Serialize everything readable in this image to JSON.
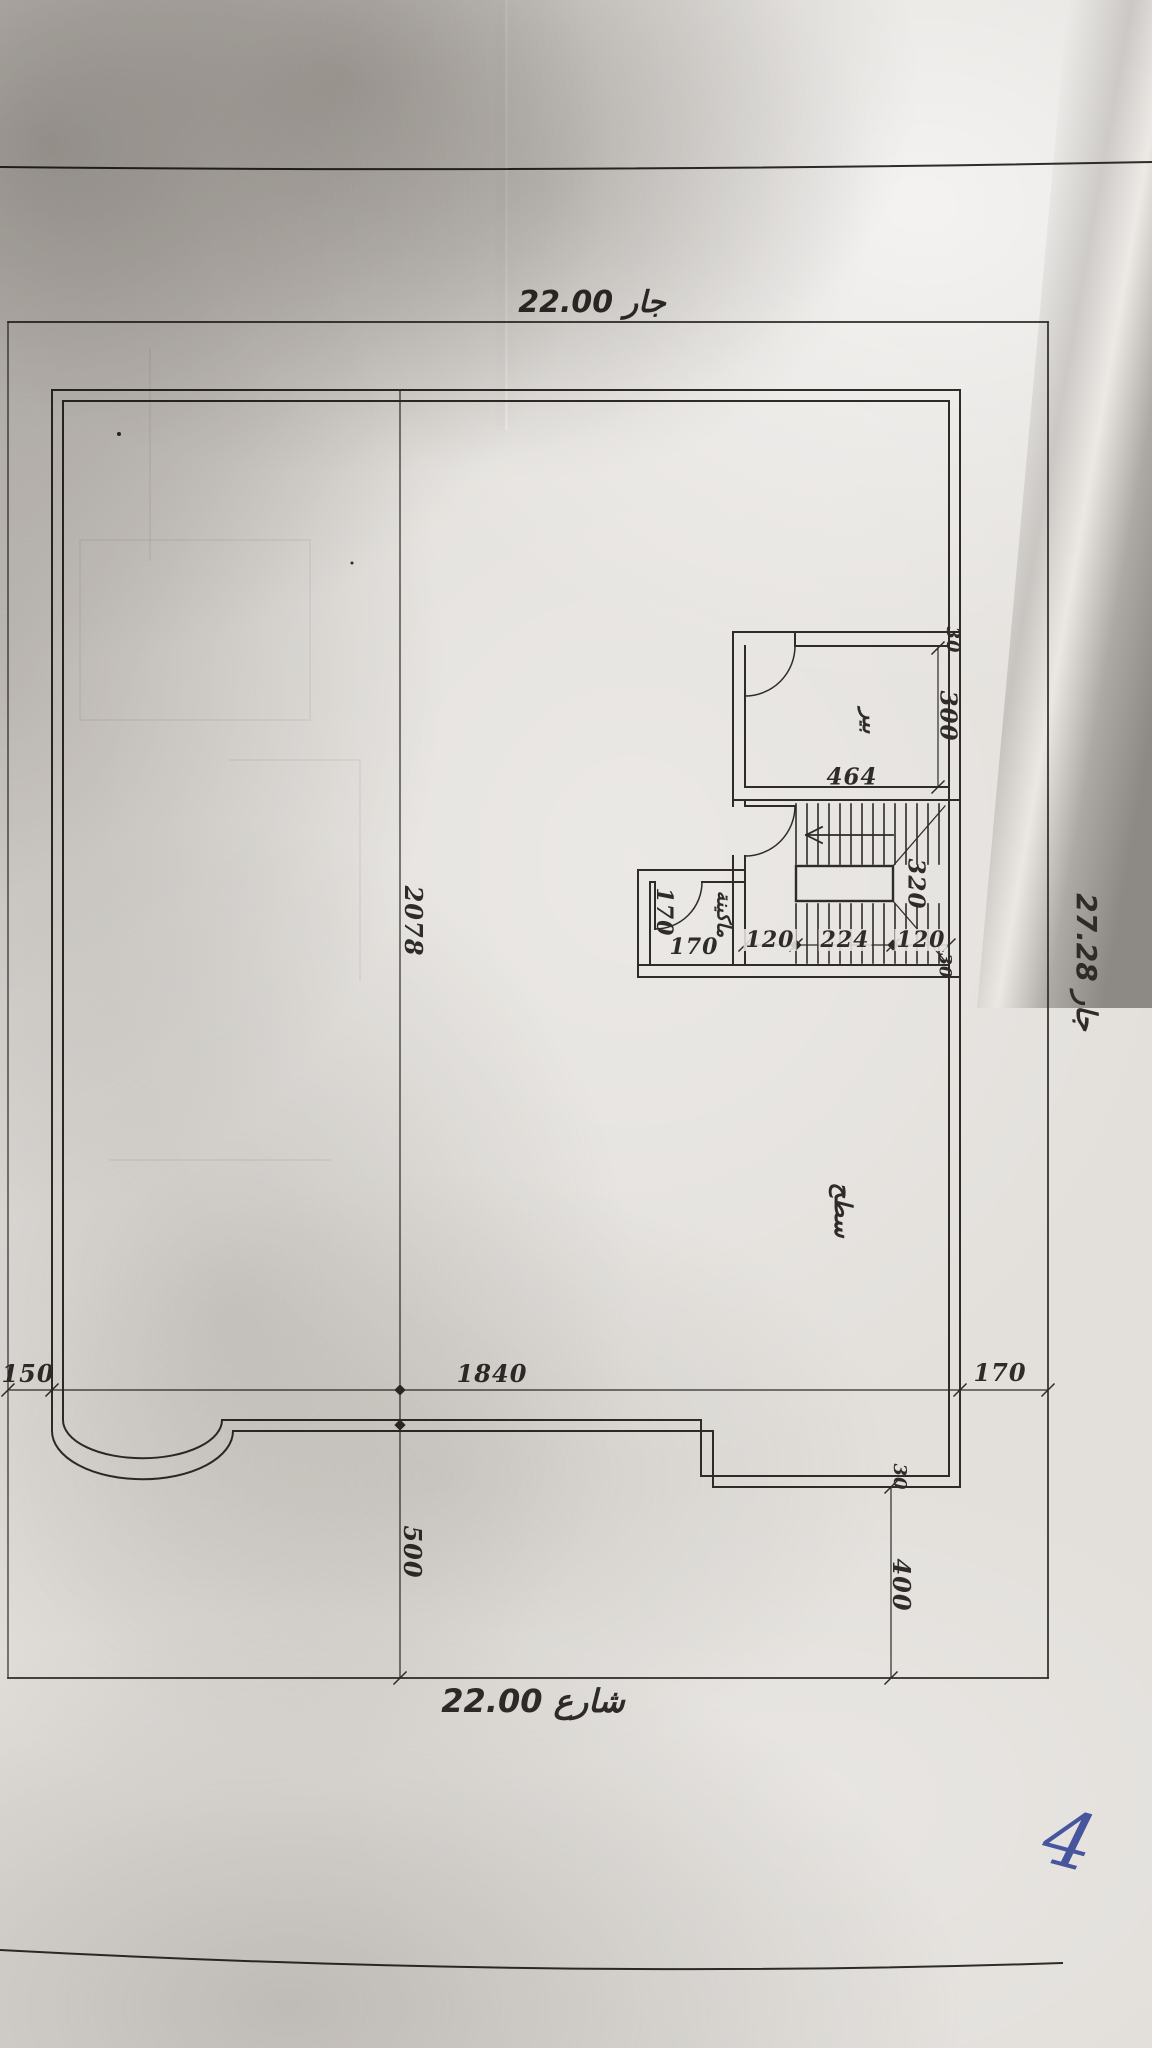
{
  "sheet": {
    "kind": "photographed architectural roof plan"
  },
  "labels": {
    "top_neighbor": "جار 22.00",
    "right_neighbor": "جار 27.28",
    "street": "شارع 22.00",
    "room_well": "بير",
    "room_machine": "ماكينة",
    "roof_surface": "سطح",
    "handwritten_mark": "4"
  },
  "dimensions": {
    "roof_depth": "2078",
    "front_setback": "500",
    "right_rear_setback": "400",
    "left_margin": "150",
    "frontage": "1840",
    "right_margin": "170",
    "well_width": "464",
    "well_depth": "300",
    "well_wall": "30",
    "stair_flight": "320",
    "stair_left": "120",
    "stair_mid": "224",
    "stair_right": "120",
    "stair_wall": "30",
    "step_wall": "30",
    "machine_width": "170",
    "machine_depth": "170"
  },
  "colors": {
    "ink": "#2e2b28",
    "pen_ink": "#3a4a97",
    "paper": "#e3e0dc"
  }
}
